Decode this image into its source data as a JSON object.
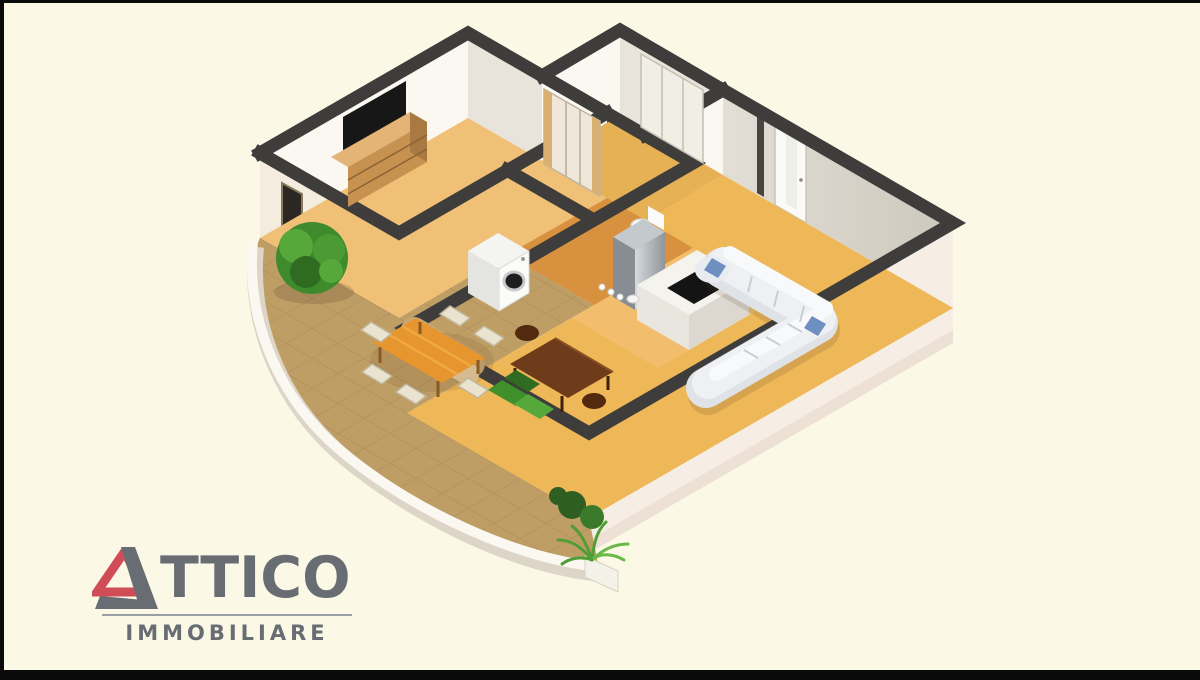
{
  "logo": {
    "brand_full": "ATTICO",
    "brand_rest": "TTICO",
    "subtitle": "IMMOBILIARE"
  },
  "scene": {
    "description": "3D isometric cutaway floor plan of an apartment with bedroom, bathroom, kitchen, living room and curved terrace"
  },
  "theme": {
    "bg": "#fbf9e6",
    "bar": "#0a0a0a",
    "wall-cap": "#3e3d3b",
    "wall-bright": "#faf8f1",
    "wall-mid": "#e8e4dc",
    "wall-ext": "#f3ecdf",
    "floor-bedroom": "#f0c076",
    "floor-hall": "#e6b154",
    "floor-bath": "#d8913e",
    "floor-living": "#eeb757",
    "floor-kitchen": "#f2bf72",
    "floor-terrace": "#bf9e66",
    "orange-wall": "#cc6f28",
    "maroon": "#7a2115",
    "gold-table": "#e6952f",
    "sofa": "#eef0f3",
    "pillow": "#6f8fc0",
    "wood": "#c79150",
    "table-brown": "#6e3c1a",
    "green": "#4c9a34",
    "green-dark": "#2e5e22",
    "steel": "#a8aeb3",
    "logo-red": "#d04d58",
    "logo-gray": "#686d74"
  }
}
